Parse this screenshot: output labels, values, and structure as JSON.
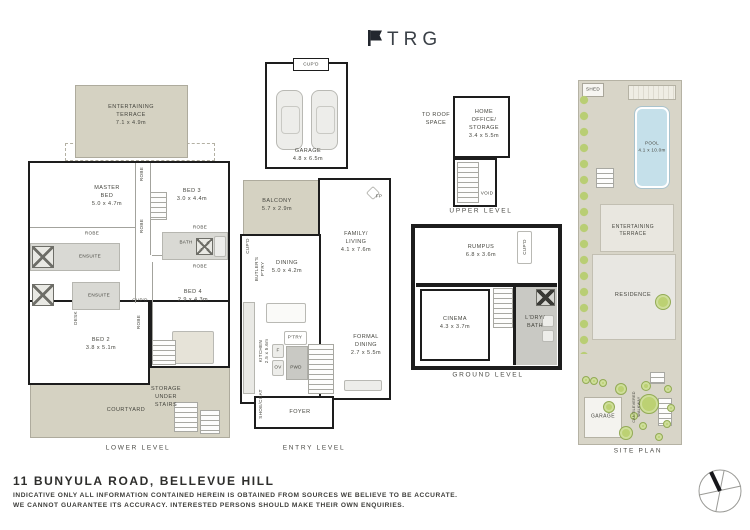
{
  "brand": {
    "name": "TRG"
  },
  "footer": {
    "title": "11 BUNYULA ROAD, BELLEVUE HILL",
    "disclaimer1": "INDICATIVE ONLY ALL INFORMATION CONTAINED HEREIN IS OBTAINED FROM SOURCES WE BELIEVE TO BE ACCURATE.",
    "disclaimer2": "WE CANNOT GUARANTEE ITS ACCURACY. INTERESTED PERSONS SHOULD MAKE THEIR OWN ENQUIRIES."
  },
  "levels": {
    "lower": {
      "label": "LOWER LEVEL",
      "rooms": {
        "terrace": "ENTERTAINING\nTERRACE\n7.1 x 4.9m",
        "master": "MASTER\nBED\n5.0 x 4.7m",
        "bed3": "BED 3\n3.0 x 4.4m",
        "robe_v1": "ROBE",
        "robe_v2": "ROBE",
        "robe_master": "ROBE",
        "ensuite1": "ENSUITE",
        "ensuite2": "ENSUITE",
        "desk": "DESK",
        "robe_r1": "ROBE",
        "bath": "BATH",
        "robe_r2": "ROBE",
        "bed4": "BED 4\n2.9 x 4.3m",
        "cupd": "CUP'D",
        "robe_v3": "ROBE",
        "bed2": "BED 2\n3.8 x 5.1m",
        "storage": "STORAGE\nUNDER\nSTAIRS",
        "courtyard": "COURTYARD"
      }
    },
    "entry": {
      "label": "ENTRY LEVEL",
      "rooms": {
        "garage_cupd": "CUP'D",
        "garage": "GARAGE\n4.8 x 6.5m",
        "balcony": "BALCONY\n5.7 x 2.9m",
        "family": "FAMILY/\nLIVING\n4.1 x 7.6m",
        "dining": "DINING\n5.0 x 4.2m",
        "cupd": "CUP'D",
        "butlers": "BUTLER'S\nP'TRY",
        "fp": "FP",
        "kitchen": "KITCHEN\n2.5 x 5.6m",
        "ptry": "P'TRY",
        "fridge": "F",
        "oven": "OV",
        "pwd": "PWD",
        "formal": "FORMAL\nDINING\n2.7 x 5.5m",
        "foyer": "FOYER",
        "shoecoat": "SHOE/COAT"
      }
    },
    "upper": {
      "label": "UPPER LEVEL",
      "rooms": {
        "toroof": "TO ROOF\nSPACE",
        "office": "HOME\nOFFICE/\nSTORAGE\n3.4 x 5.5m",
        "void": "VOID"
      }
    },
    "ground": {
      "label": "GROUND LEVEL",
      "rooms": {
        "rumpus": "RUMPUS\n6.8 x 3.6m",
        "cupd": "CUP'D",
        "cinema": "CINEMA\n4.3 x 3.7m",
        "ldry": "L'DRY/\nBATH"
      }
    },
    "site": {
      "label": "SITE PLAN",
      "rooms": {
        "shed": "SHED",
        "pool": "POOL\n4.1 x 10.0m",
        "terrace": "ENTERTAINING\nTERRACE",
        "residence": "RESIDENCE",
        "garage": "GARAGE",
        "walkway": "CANTILEVERED\nWALKWAY"
      }
    }
  },
  "colors": {
    "outdoor_beige": "#d5d2c2",
    "grass": "#e7ecca",
    "pool": "#c5e0ea",
    "tree": "#bcd173",
    "wall": "#1d1d1d"
  }
}
